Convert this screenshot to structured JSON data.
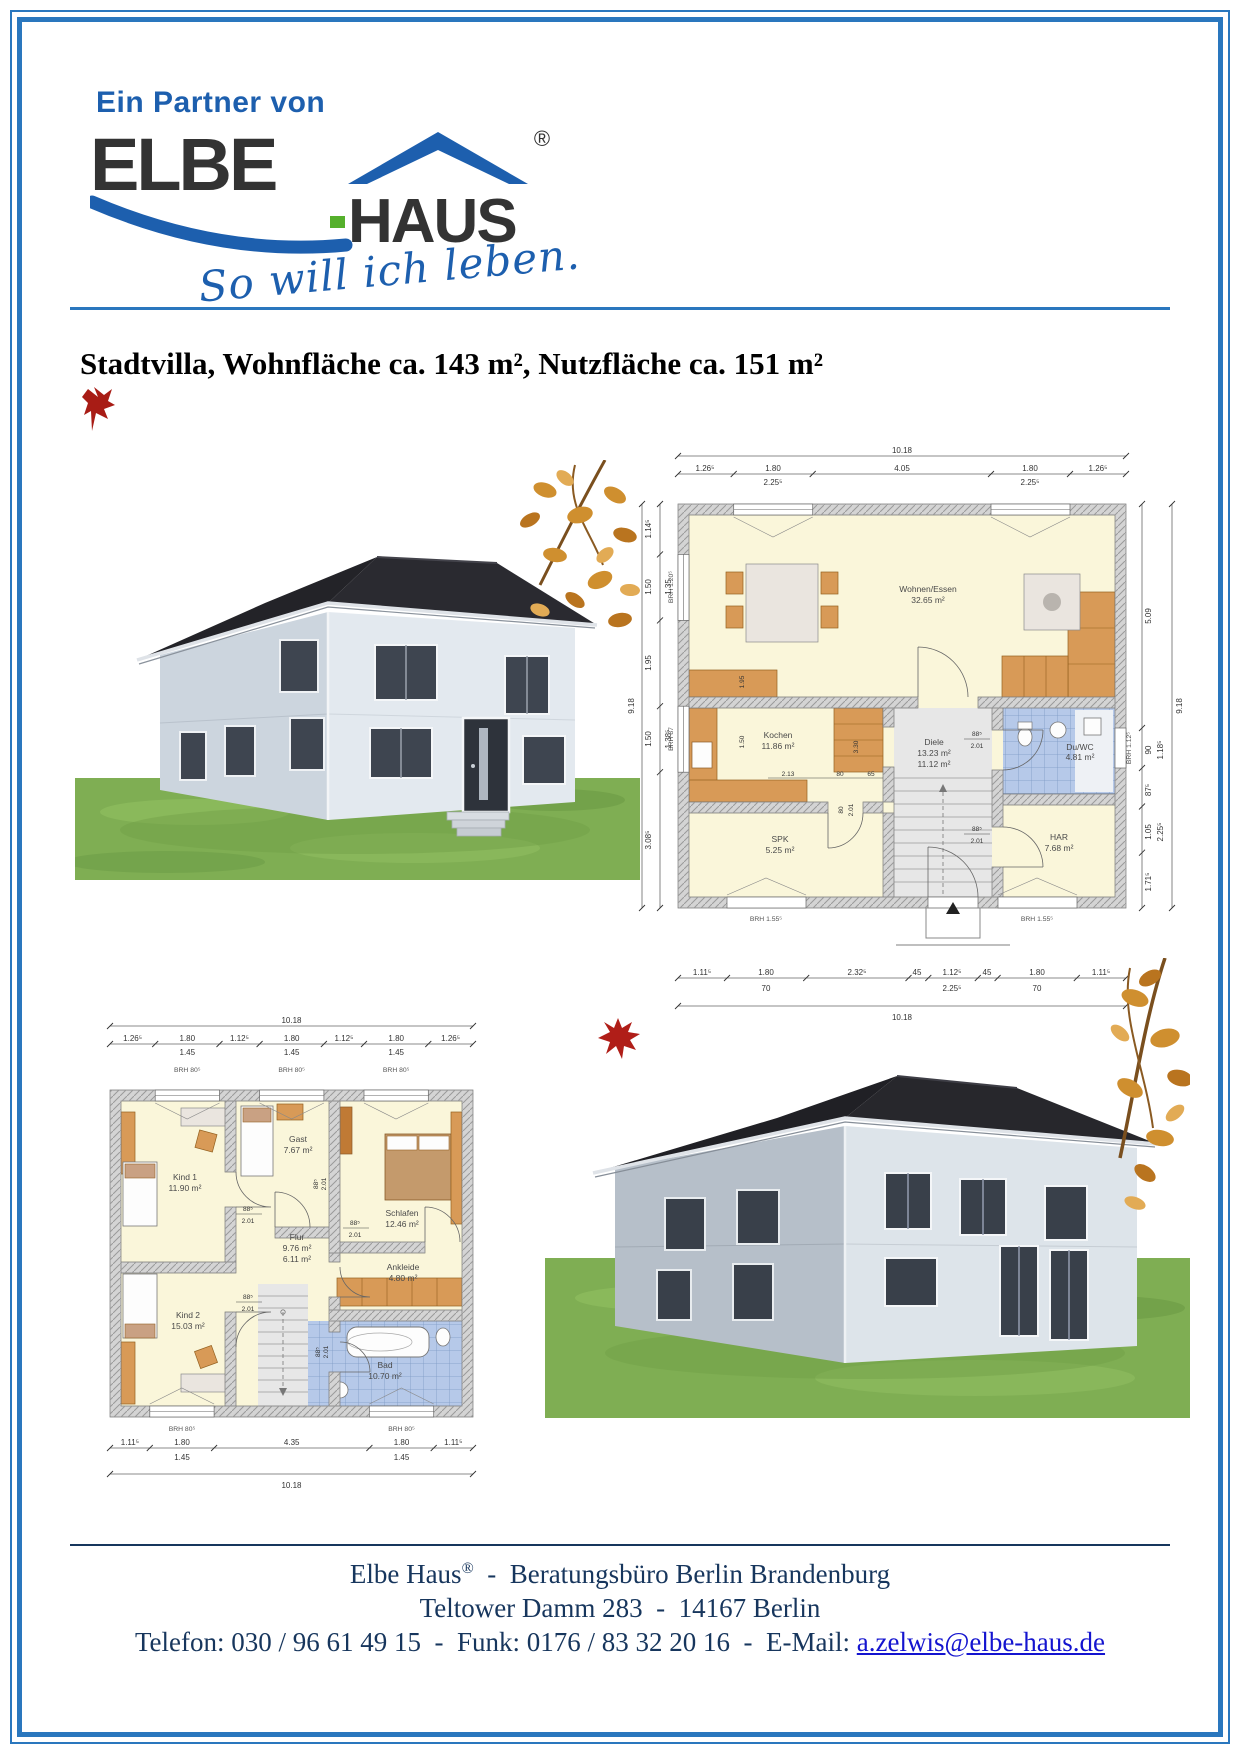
{
  "page": {
    "partner": "Ein Partner von",
    "logo": {
      "elbe": "ELBE",
      "haus": "HAUS",
      "reg": "®",
      "slogan": "So will ich leben."
    },
    "title": "Stadtvilla, Wohnfläche ca. 143 m², Nutzfläche ca. 151 m²"
  },
  "eg": {
    "top_total": "10.18",
    "top_parts": [
      "1.26⁵",
      "1.80",
      "4.05",
      "1.80",
      "1.26⁵"
    ],
    "top_subs": [
      "2.25⁵",
      "2.25⁵"
    ],
    "bottom_parts": [
      "1.11⁵",
      "1.80",
      "2.32⁵",
      "45",
      "1.12⁵",
      "45",
      "1.80",
      "1.11⁵"
    ],
    "bottom_subs": [
      "70",
      "2.25⁵",
      "70"
    ],
    "bottom_total": "10.18",
    "left_parts": [
      "1.14⁵",
      "1.50",
      "1.95",
      "1.50",
      "3.08⁵"
    ],
    "left_subs": [
      "1.35",
      "1.38⁵"
    ],
    "left_total": "9.18",
    "right_parts": [
      "5.09",
      "90",
      "87⁵",
      "1.05",
      "1.71⁵"
    ],
    "right_subs": [
      "1.18⁵",
      "2.25⁵"
    ],
    "right_total": "9.18",
    "rooms": {
      "wohnen": {
        "n": "Wohnen/Essen",
        "a": "32.65 m²"
      },
      "kochen": {
        "n": "Kochen",
        "a": "11.86 m²"
      },
      "diele": {
        "n": "Diele",
        "a": "13.23 m²",
        "a2": "11.12 m²"
      },
      "duwc": {
        "n": "Du/WC",
        "a": "4.81 m²"
      },
      "har": {
        "n": "HAR",
        "a": "7.68 m²"
      },
      "spk": {
        "n": "SPK",
        "a": "5.25 m²"
      }
    },
    "inner": {
      "d1": "2.13",
      "d2": "80",
      "d3": "65",
      "d4": "3.30",
      "d5": "1.95",
      "d6": "1.50",
      "door": "88⁵",
      "doorh": "2.01",
      "door2": "80",
      "door2h": "2.01"
    },
    "brh": {
      "lt": "BRH 1.20⁵",
      "lb": "BRH 87",
      "r": "BRH 1.12⁵",
      "b1": "BRH 1.55⁵",
      "b2": "BRH 1.55⁵"
    }
  },
  "og": {
    "top_total": "10.18",
    "top_parts": [
      "1.26⁵",
      "1.80",
      "1.12⁵",
      "1.80",
      "1.12⁵",
      "1.80",
      "1.26⁵"
    ],
    "top_subs": [
      "1.45",
      "1.45",
      "1.45"
    ],
    "bottom_parts": [
      "1.11⁵",
      "1.80",
      "4.35",
      "1.80",
      "1.11⁵"
    ],
    "bottom_subs": [
      "1.45",
      "1.45"
    ],
    "bottom_total": "10.18",
    "brh_top": [
      "BRH 80⁵",
      "BRH 80⁵",
      "BRH 80⁵"
    ],
    "brh_bottom": [
      "BRH 80⁵",
      "BRH 80⁵"
    ],
    "rooms": {
      "kind1": {
        "n": "Kind 1",
        "a": "11.90 m²"
      },
      "gast": {
        "n": "Gast",
        "a": "7.67 m²"
      },
      "schlafen": {
        "n": "Schlafen",
        "a": "12.46 m²"
      },
      "flur": {
        "n": "Flur",
        "a": "9.76 m²",
        "a2": "6.11 m²"
      },
      "ankleide": {
        "n": "Ankleide",
        "a": "4.80 m²"
      },
      "kind2": {
        "n": "Kind 2",
        "a": "15.03 m²"
      },
      "bad": {
        "n": "Bad",
        "a": "10.70 m²"
      }
    },
    "door": "88⁵",
    "doorh": "2.01"
  },
  "footer": {
    "line1_name": "Elbe Haus",
    "line1_reg": "®",
    "line1_rest": "  -  Beratungsbüro Berlin Brandenburg",
    "line2": "Teltower Damm 283  -  14167 Berlin",
    "line3_prefix": "Telefon: 030 / 96 61 49 15  -  Funk: 0176 / 83 32 20 16  -  E-Mail: ",
    "email": "a.zelwis@elbe-haus.de"
  },
  "colors": {
    "frame_blue": "#2a77be",
    "logo_blue": "#1d5fae",
    "logo_green": "#55b02c",
    "footer_navy": "#17365d",
    "link_blue": "#1414cf",
    "plan_cream": "#faf6da",
    "plan_tile_blue": "#b6c9e9",
    "grass_green": "#7fae53",
    "roof_dark": "#232328"
  }
}
